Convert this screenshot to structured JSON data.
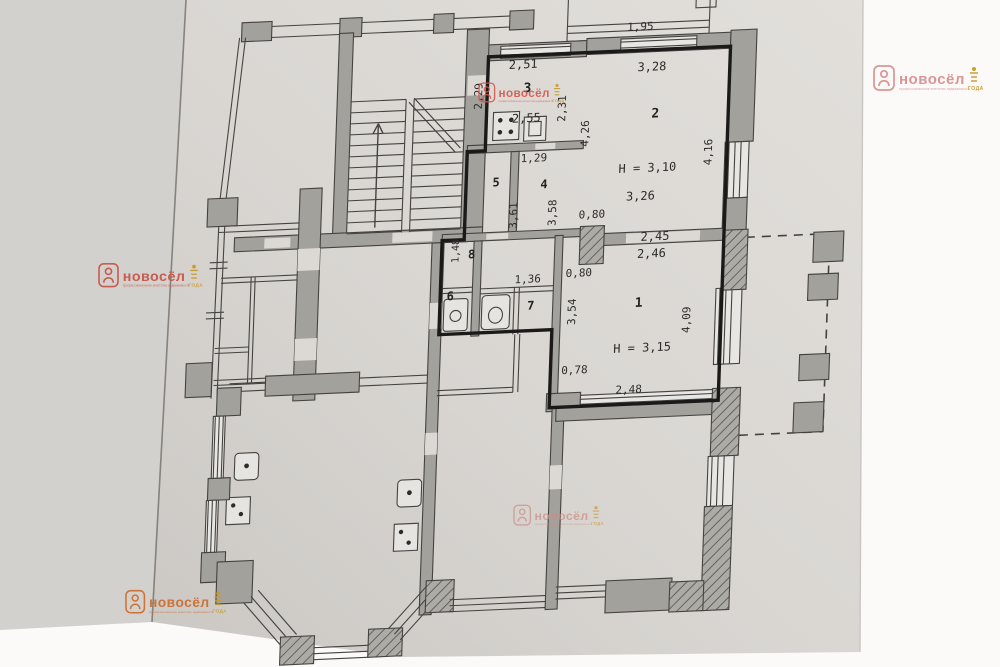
{
  "document": {
    "type": "floor-plan-scan",
    "language": "ru"
  },
  "colors": {
    "background": "#fbfaf8",
    "paper_light": "#e2dfdb",
    "paper_dark": "#cbc8c4",
    "side_strip": "#d3d1cd",
    "wall_fill": "#a3a19c",
    "line": "#45433f",
    "bold_outline": "#1b1a18",
    "hatch_bg": "#adaba6",
    "hatch_line": "#63605a",
    "text": "#2d2c29",
    "watermark_red": "#c8564b",
    "watermark_pink": "#d99090",
    "watermark_orange": "#cc6f33",
    "badge_gold": "#c99b2e"
  },
  "watermark": {
    "brand": "новосёл",
    "tagline": "профессиональное агентство недвижимости",
    "badge_text": "ГОДА",
    "instances": [
      {
        "x": 874,
        "y": 62,
        "scale": 1.0,
        "color": "#d99090",
        "opacity": 0.95
      },
      {
        "x": 479,
        "y": 80,
        "scale": 0.78,
        "color": "#d4584a",
        "opacity": 0.9
      },
      {
        "x": 99,
        "y": 260,
        "scale": 0.95,
        "color": "#c8564b",
        "opacity": 0.95
      },
      {
        "x": 514,
        "y": 502,
        "scale": 0.82,
        "color": "#cb8c84",
        "opacity": 0.7
      },
      {
        "x": 126,
        "y": 587,
        "scale": 0.92,
        "color": "#cc6f33",
        "opacity": 0.95
      }
    ]
  },
  "plan": {
    "height_labels": [
      "Н = 3,10",
      "Н = 3,15"
    ],
    "labels": [
      {
        "kind": "dimension",
        "text": "1,95",
        "x": 631,
        "y": 36,
        "rot": 0,
        "size": 11
      },
      {
        "kind": "dimension",
        "text": "2,51",
        "x": 515,
        "y": 69,
        "rot": 0,
        "size": 12
      },
      {
        "kind": "dimension",
        "text": "3,28",
        "x": 644,
        "y": 77,
        "rot": 0,
        "size": 12
      },
      {
        "kind": "dimension",
        "text": "2,29",
        "x": 475,
        "y": 95,
        "rot": -90,
        "size": 11
      },
      {
        "kind": "room-number",
        "text": "3",
        "x": 520,
        "y": 93,
        "rot": 0,
        "size": 13
      },
      {
        "kind": "dimension",
        "text": "2,55",
        "x": 520,
        "y": 123,
        "rot": 0,
        "size": 12
      },
      {
        "kind": "dimension",
        "text": "2,31",
        "x": 559,
        "y": 111,
        "rot": -90,
        "size": 11
      },
      {
        "kind": "room-number",
        "text": "2",
        "x": 649,
        "y": 124,
        "rot": 0,
        "size": 13
      },
      {
        "kind": "dimension",
        "text": "4,26",
        "x": 583,
        "y": 137,
        "rot": -90,
        "size": 11
      },
      {
        "kind": "dimension",
        "text": "4,16",
        "x": 707,
        "y": 161,
        "rot": -90,
        "size": 11
      },
      {
        "kind": "height",
        "text": "Н = 3,10",
        "x": 643,
        "y": 178,
        "rot": 0,
        "size": 12
      },
      {
        "kind": "dimension",
        "text": "3,26",
        "x": 637,
        "y": 206,
        "rot": 0,
        "size": 12
      },
      {
        "kind": "dimension",
        "text": "1,29",
        "x": 529,
        "y": 163,
        "rot": 0,
        "size": 11
      },
      {
        "kind": "room-number",
        "text": "5",
        "x": 492,
        "y": 186,
        "rot": 0,
        "size": 12
      },
      {
        "kind": "room-number",
        "text": "4",
        "x": 540,
        "y": 190,
        "rot": 0,
        "size": 12
      },
      {
        "kind": "dimension",
        "text": "3,61",
        "x": 514,
        "y": 216,
        "rot": -90,
        "size": 11
      },
      {
        "kind": "dimension",
        "text": "3,58",
        "x": 553,
        "y": 215,
        "rot": -90,
        "size": 11
      },
      {
        "kind": "dimension",
        "text": "0,80",
        "x": 589,
        "y": 222,
        "rot": 0,
        "size": 11
      },
      {
        "kind": "dimension",
        "text": "2,45",
        "x": 653,
        "y": 247,
        "rot": 0,
        "size": 12
      },
      {
        "kind": "dimension",
        "text": "2,46",
        "x": 650,
        "y": 264,
        "rot": 0,
        "size": 12
      },
      {
        "kind": "dimension",
        "text": "1,48",
        "x": 457,
        "y": 249,
        "rot": -90,
        "size": 10
      },
      {
        "kind": "room-number",
        "text": "8",
        "x": 470,
        "y": 257,
        "rot": 0,
        "size": 12
      },
      {
        "kind": "dimension",
        "text": "1,36",
        "x": 527,
        "y": 284,
        "rot": 0,
        "size": 11
      },
      {
        "kind": "dimension",
        "text": "0,80",
        "x": 578,
        "y": 280,
        "rot": 0,
        "size": 11
      },
      {
        "kind": "room-number",
        "text": "6",
        "x": 450,
        "y": 298,
        "rot": 0,
        "size": 12
      },
      {
        "kind": "room-number",
        "text": "7",
        "x": 531,
        "y": 311,
        "rot": 0,
        "size": 12
      },
      {
        "kind": "dimension",
        "text": "3,54",
        "x": 576,
        "y": 315,
        "rot": -90,
        "size": 11
      },
      {
        "kind": "room-number",
        "text": "1",
        "x": 639,
        "y": 313,
        "rot": 0,
        "size": 13
      },
      {
        "kind": "height",
        "text": "Н = 3,15",
        "x": 644,
        "y": 358,
        "rot": 0,
        "size": 12
      },
      {
        "kind": "dimension",
        "text": "4,09",
        "x": 691,
        "y": 328,
        "rot": -90,
        "size": 11
      },
      {
        "kind": "dimension",
        "text": "0,78",
        "x": 577,
        "y": 377,
        "rot": 0,
        "size": 11
      },
      {
        "kind": "dimension",
        "text": "2,48",
        "x": 632,
        "y": 399,
        "rot": 0,
        "size": 11
      }
    ]
  }
}
